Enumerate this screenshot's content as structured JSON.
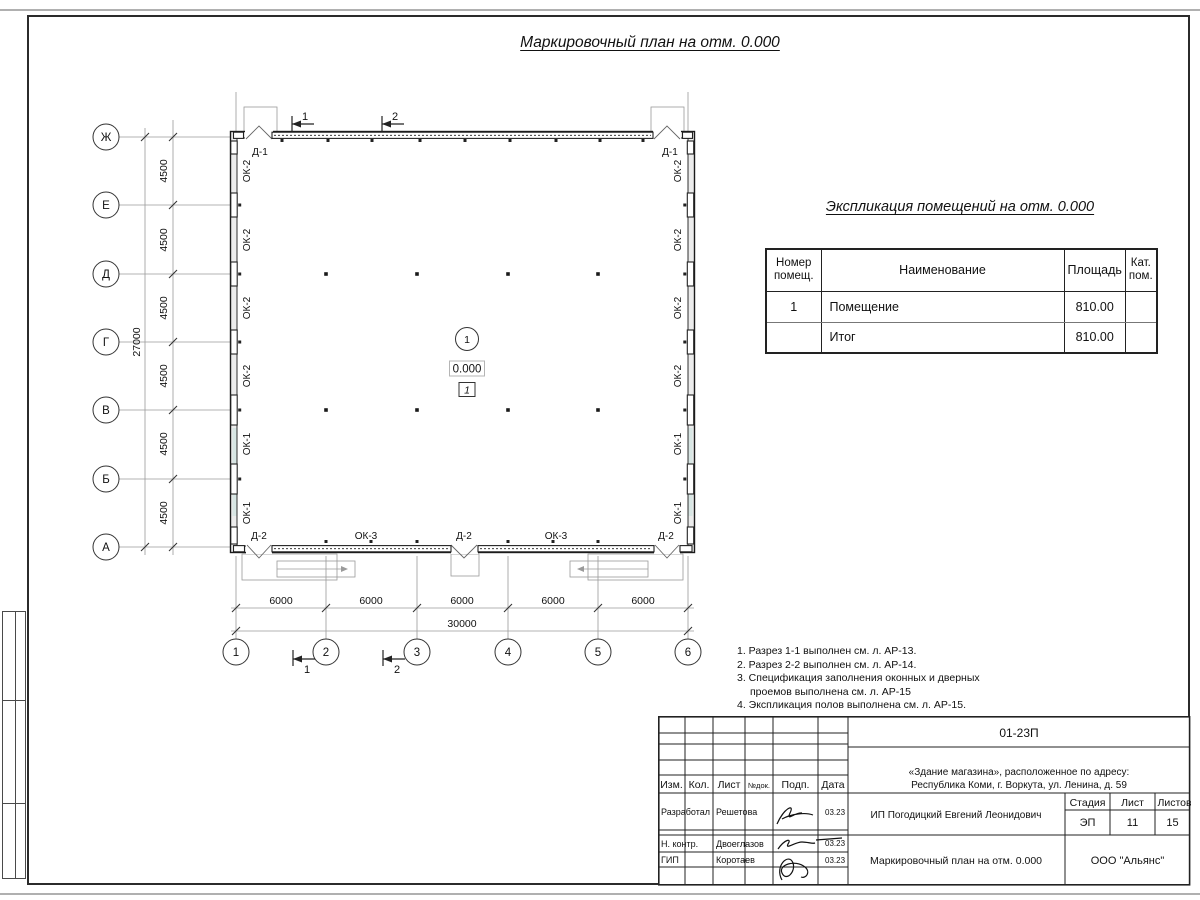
{
  "sheet": {
    "title": "Маркировочный план на отм. 0.000"
  },
  "plan": {
    "row_axes": [
      "Ж",
      "Е",
      "Д",
      "Г",
      "В",
      "Б",
      "А"
    ],
    "col_axes": [
      "1",
      "2",
      "3",
      "4",
      "5",
      "6"
    ],
    "row_dims": [
      "4500",
      "4500",
      "4500",
      "4500",
      "4500",
      "4500"
    ],
    "row_total": "27000",
    "col_dims": [
      "6000",
      "6000",
      "6000",
      "6000",
      "6000"
    ],
    "col_total": "30000",
    "left_windows": [
      "ОК-2",
      "ОК-2",
      "ОК-2",
      "ОК-2",
      "ОК-1",
      "ОК-1"
    ],
    "right_windows": [
      "ОК-2",
      "ОК-2",
      "ОК-2",
      "ОК-2",
      "ОК-1",
      "ОК-1"
    ],
    "top_doors": [
      "Д-1",
      "Д-1"
    ],
    "bottom_labels": [
      "Д-2",
      "ОК-3",
      "Д-2",
      "ОК-3",
      "Д-2"
    ],
    "sections_top": [
      "1",
      "2"
    ],
    "sections_bottom": [
      "1",
      "2"
    ],
    "room": {
      "number": "1",
      "elevation": "0.000",
      "floor_type": "1"
    }
  },
  "explication": {
    "title": "Экспликация помещений на отм. 0.000",
    "headers": [
      "Номер помещ.",
      "Наименование",
      "Площадь",
      "Кат. пом."
    ],
    "rows": [
      {
        "num": "1",
        "name": "Помещение",
        "area": "810.00",
        "cat": ""
      },
      {
        "num": "",
        "name": "Итог",
        "area": "810.00",
        "cat": ""
      }
    ]
  },
  "notes": {
    "items": [
      "1. Разрез 1-1 выполнен см. л. АР-13.",
      "2. Разрез 2-2 выполнен см. л. АР-14.",
      "3. Спецификация заполнения оконных и дверных",
      "проемов выполнена см. л. АР-15",
      "4. Экспликация полов выполнена см. л. АР-15."
    ]
  },
  "stamp": {
    "doc_number": "01-23П",
    "object_line1": "«Здание магазина», расположенное по адресу:",
    "object_line2": "Республика Коми, г. Воркута, ул. Ленина, д. 59",
    "client": "ИП Погодицкий Евгений Леонидович",
    "sheet_title": "Маркировочный план на отм. 0.000",
    "org": "ООО \"Альянс\"",
    "cols": {
      "izm": "Изм.",
      "kol": "Кол.",
      "list": "Лист",
      "ndok": "№док.",
      "podp": "Подп.",
      "data": "Дата"
    },
    "stage_header": {
      "stage": "Стадия",
      "sheet": "Лист",
      "sheets": "Листов"
    },
    "stage": "ЭП",
    "sheet_num": "11",
    "sheets_total": "15",
    "rows": [
      {
        "role": "Разработал",
        "name": "Решетова",
        "date": "03.23"
      },
      {
        "role": "Н. контр.",
        "name": "Двоеглазов",
        "date": "03.23"
      },
      {
        "role": "ГИП",
        "name": "Коротаев",
        "date": "03.23"
      }
    ]
  }
}
